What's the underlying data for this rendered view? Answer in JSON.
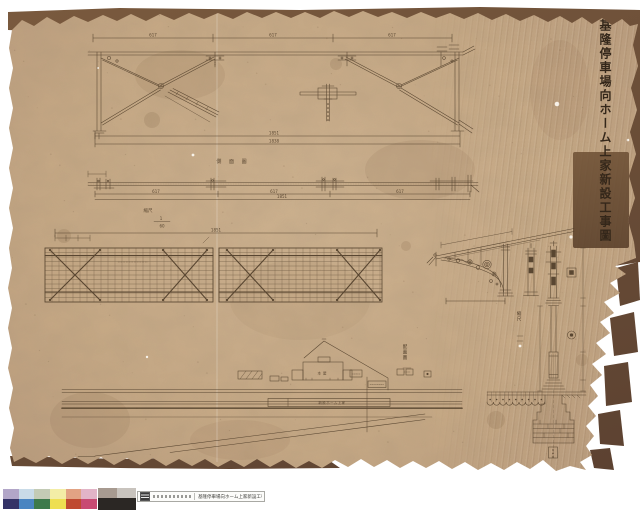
{
  "document": {
    "title": "基隆停車場向ホーム上家新設工事圖"
  },
  "truss": {
    "span_dims": [
      "617",
      "617",
      "617"
    ],
    "total_dim": "1851",
    "lower_dim": "1838"
  },
  "beam": {
    "title": "側 面 圖",
    "span_dims": [
      "617",
      "617",
      "617"
    ],
    "total_dim": "1851",
    "scale_label": "縮尺",
    "scale_num": "1",
    "scale_den": "60"
  },
  "roof_plan": {
    "total_dim": "1851"
  },
  "site_plan": {
    "title": "配置圖",
    "building_label": "本屋",
    "platform_label": "新設ホーム上家"
  },
  "detail": {
    "scale_label": "縮尺"
  },
  "archive_label": {
    "icon": "document-icon",
    "title": "基隆停車場向ホーム上家新設工事圖"
  },
  "colors": {
    "paper": "#c8aa86",
    "backing": "#6b4b33",
    "ink": "#4e3c28",
    "repair_patch": "#75533a"
  },
  "calibration": {
    "top_row": [
      "#b2a6c8",
      "#c9dbe8",
      "#c3cbb5",
      "#f3eda6",
      "#e2a384",
      "#e2b4c7"
    ],
    "bottom_row": [
      "#343367",
      "#4a85c1",
      "#3d7a4b",
      "#eedf51",
      "#bf4a31",
      "#c84b73"
    ],
    "gray_top": [
      "#a79a90",
      "#c8c3bd"
    ],
    "gray_bottom": "#2b2724"
  }
}
